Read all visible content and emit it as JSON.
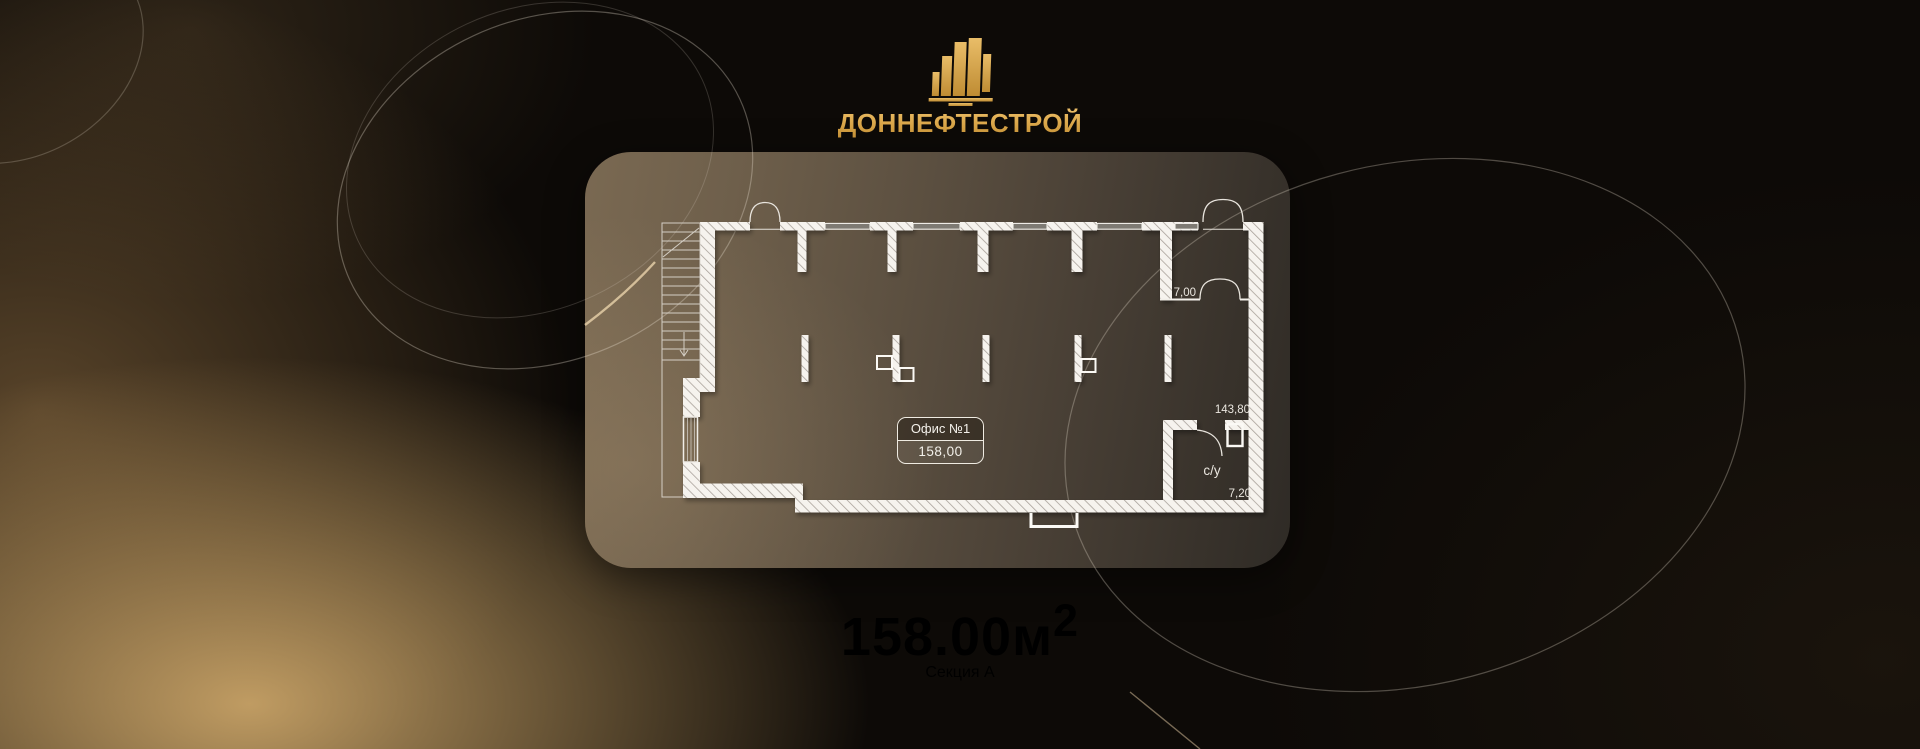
{
  "brand": {
    "name": "ДОННЕФТЕСТРОЙ"
  },
  "plan": {
    "office": {
      "label": "Офис №1",
      "area": "158,00"
    },
    "annotations": {
      "room_area": "7,00",
      "dim_length": "143,80",
      "bathroom": "с/у",
      "bathroom_area": "7,20"
    }
  },
  "summary": {
    "area_value": "158.00",
    "area_unit": "м",
    "area_sup": "2",
    "section": "Секция А"
  },
  "colors": {
    "gold": "#d9a64d",
    "wall_white": "#f6f3ee",
    "text_light": "#edeae4",
    "card_brown": "#5b4f40",
    "background_dark": "#0d0a07"
  }
}
